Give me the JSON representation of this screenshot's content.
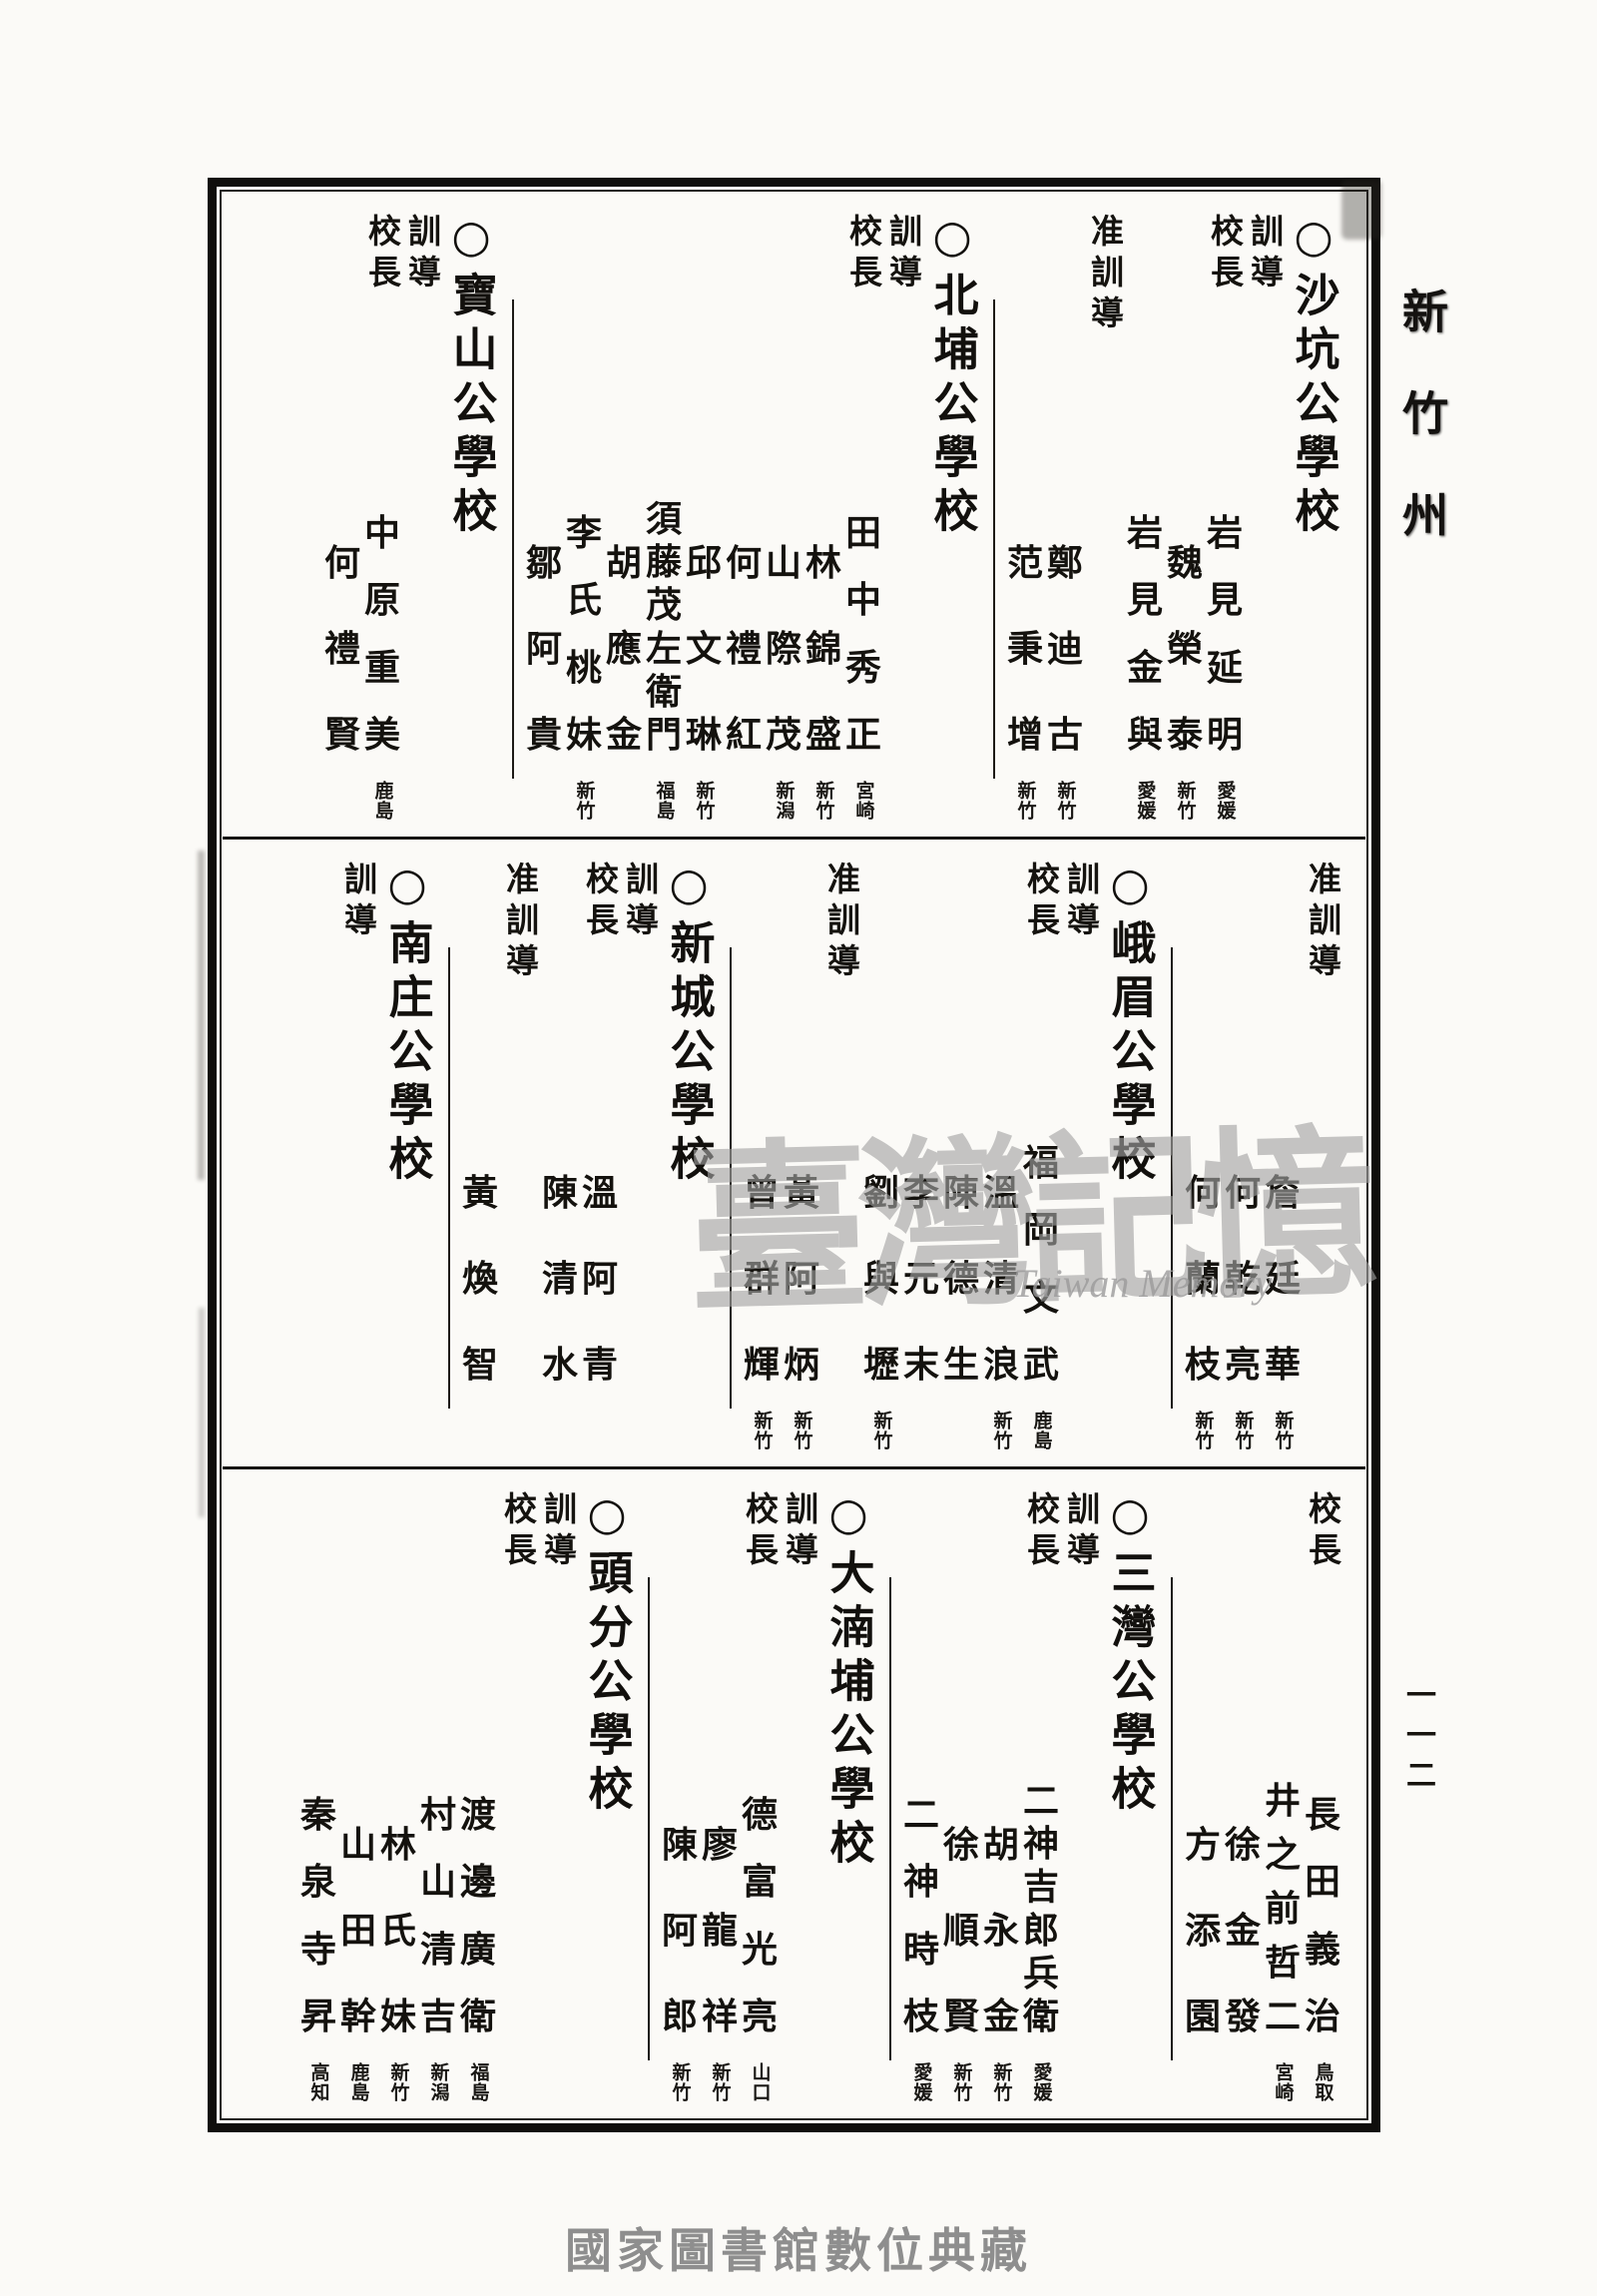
{
  "page": {
    "margin_title": "新竹州",
    "page_number": "一一二",
    "footer_caption": "國家圖書館數位典藏",
    "watermark_cjk": "臺灣記憶",
    "watermark_latin": "Taiwan Memory"
  },
  "colors": {
    "ink": "#14120e",
    "paper": "#fbfaf7",
    "watermark_gray": "#a3a3a3",
    "footer_gray": "#8e8e8e"
  },
  "role_labels": [
    "校長",
    "訓導",
    "准訓導"
  ],
  "bands": [
    {
      "columns": [
        {
          "school": "○沙坑公學校"
        },
        {
          "label": "訓導"
        },
        {
          "label": "校長",
          "name": "岩見延明",
          "note": "愛媛"
        },
        {
          "name": "魏榮泰",
          "note": "新竹"
        },
        {
          "name": "岩見金與",
          "note": "愛媛"
        },
        {
          "label": "准訓導"
        },
        {
          "name": "鄭迪古",
          "note": "新竹"
        },
        {
          "name": "范秉增",
          "note": "新竹"
        },
        {
          "rule": true
        },
        {
          "school": "○北埔公學校"
        },
        {
          "label": "訓導"
        },
        {
          "label": "校長",
          "name": "田中秀正",
          "note": "宮崎"
        },
        {
          "name": "林錦盛",
          "note": "新竹"
        },
        {
          "name": "山際茂",
          "note": "新潟"
        },
        {
          "name": "何禮紅",
          "note": ""
        },
        {
          "name": "邱文琳",
          "note": "新竹"
        },
        {
          "name": "須藤茂左衛門",
          "note": "福島"
        },
        {
          "name": "胡應金",
          "note": ""
        },
        {
          "name": "李氏桃妹",
          "note": "新竹"
        },
        {
          "name": "鄒阿貴",
          "note": ""
        },
        {
          "rule": true
        },
        {
          "school": "○寶山公學校"
        },
        {
          "label": "訓導"
        },
        {
          "label": "校長",
          "name": "中原重美",
          "note": "鹿島"
        },
        {
          "name": "何禮賢",
          "note": ""
        }
      ]
    },
    {
      "columns": [
        {
          "label": "准訓導"
        },
        {
          "name": "詹廷華",
          "note": "新竹"
        },
        {
          "name": "何乾亮",
          "note": "新竹"
        },
        {
          "name": "何蘭枝",
          "note": "新竹"
        },
        {
          "rule": true
        },
        {
          "school": "○峨眉公學校"
        },
        {
          "label": "訓導"
        },
        {
          "label": "校長",
          "name": "福岡文武",
          "note": "鹿島"
        },
        {
          "name": "溫清浪",
          "note": "新竹"
        },
        {
          "name": "陳德生",
          "note": ""
        },
        {
          "name": "李元末",
          "note": ""
        },
        {
          "name": "劉與壢",
          "note": "新竹"
        },
        {
          "label": "准訓導"
        },
        {
          "name": "黃阿炳",
          "note": "新竹"
        },
        {
          "name": "曾群輝",
          "note": "新竹"
        },
        {
          "rule": true
        },
        {
          "school": "○新城公學校"
        },
        {
          "label": "訓導"
        },
        {
          "label": "校長",
          "name": "溫阿青",
          "note": ""
        },
        {
          "name": "陳清水",
          "note": ""
        },
        {
          "label": "准訓導"
        },
        {
          "name": "黃煥智",
          "note": ""
        },
        {
          "rule": true
        },
        {
          "school": "○南庄公學校"
        },
        {
          "label": "訓導"
        }
      ]
    },
    {
      "columns": [
        {
          "label": "校長",
          "name": "長田義治",
          "note": "鳥取"
        },
        {
          "name": "井之前哲二",
          "note": "宮崎"
        },
        {
          "name": "徐金發",
          "note": ""
        },
        {
          "name": "方添園",
          "note": ""
        },
        {
          "rule": true
        },
        {
          "school": "○三灣公學校"
        },
        {
          "label": "訓導"
        },
        {
          "label": "校長",
          "name": "二神吉郎兵衛",
          "note": "愛媛"
        },
        {
          "name": "胡永金",
          "note": "新竹"
        },
        {
          "name": "徐順賢",
          "note": "新竹"
        },
        {
          "name": "二神時枝",
          "note": "愛媛"
        },
        {
          "rule": true
        },
        {
          "school": "○大湳埔公學校"
        },
        {
          "label": "訓導"
        },
        {
          "label": "校長",
          "name": "德富光亮",
          "note": "山口"
        },
        {
          "name": "廖龍祥",
          "note": "新竹"
        },
        {
          "name": "陳阿郎",
          "note": "新竹"
        },
        {
          "rule": true
        },
        {
          "school": "○頭分公學校"
        },
        {
          "label": "訓導"
        },
        {
          "label": "校長"
        },
        {
          "name": "渡邊廣衛",
          "note": "福島"
        },
        {
          "name": "村山清吉",
          "note": "新潟"
        },
        {
          "name": "林氏妹",
          "note": "新竹"
        },
        {
          "name": "山田幹",
          "note": "鹿島"
        },
        {
          "name": "秦泉寺昇",
          "note": "高知"
        }
      ]
    }
  ]
}
